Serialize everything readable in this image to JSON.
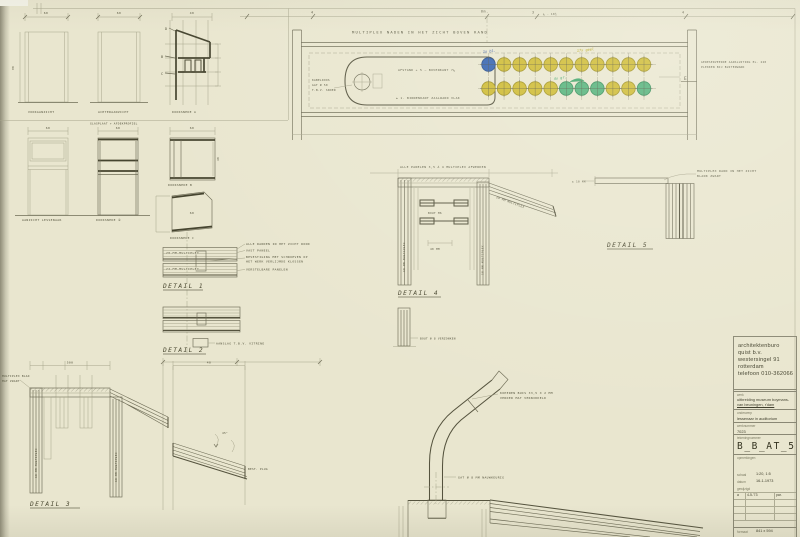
{
  "title_block": {
    "firm_lines": [
      "architektenburo",
      "quist b.v.",
      "westersingel 91",
      "rotterdam",
      "telefoon 010-362066"
    ],
    "werk_label": "werk",
    "werk_value_1": "uitbreiding museum boymans-",
    "werk_value_2": "van beuningen, r'dam",
    "onderwerp_label": "onderwerp",
    "onderwerp_value": "lessenaar in auditorium",
    "werknummer_label": "werknummer",
    "werknummer_value": "7023",
    "tekeningnummer_label": "tekeningnummer",
    "tekeningnummer_value": "B_B_AT_5",
    "opmerkingen_label": "opmerkingen",
    "schaal_label": "schaal",
    "schaal_value": "1:20, 1:5",
    "datum_label": "datum",
    "datum_value": "16-1-1973",
    "gewijzigd_label": "gewijzigd",
    "gewijzigd_row": {
      "letter": "a",
      "date": "4-5-'73",
      "par": "par."
    },
    "formaat_label": "formaat",
    "formaat_value": "841 x 594"
  },
  "plan": {
    "top_note": "MULTIPLEX NADEN IN HET ZICHT BOVEN RAND",
    "dim_4_left": "4",
    "dim_6m": "6m.",
    "dim_3": "3",
    "dim_fraction": "¼ - 10½",
    "dim_4_right": "4",
    "lectern_note_1": "AFSTAND + 5 — BOVENKANT 7¼",
    "lectern_note_2": "± 1. BINNENKANT ZAALWAND VLAK",
    "left_note_lines": [
      "KABELDOOS",
      "GAT Ø 50",
      "T.B.V. SNOER"
    ],
    "right_note_1": "GERESERVEERDE AANSLUITING EL. 220",
    "right_note_2": "PLEKKEN BIJ BUITENWAND",
    "marker_e": "E",
    "count_blue": "1x bl.",
    "count_yellow": "17x geel",
    "count_green": "4x gr.",
    "circle_rows": [
      [
        "blue",
        "yellow",
        "yellow",
        "yellow",
        "yellow",
        "yellow",
        "yellow",
        "yellow",
        "yellow",
        "yellow",
        "yellow"
      ],
      [
        "yellow",
        "yellow",
        "yellow",
        "yellow",
        "yellow",
        "green",
        "green",
        "green",
        "yellow",
        "yellow",
        "green"
      ]
    ],
    "colors": {
      "blue": "#2f5fae",
      "blue_stroke": "#1f4687",
      "yellow": "#cdb92e",
      "yellow_stroke": "#9e8f1b",
      "green": "#4fb077",
      "green_stroke": "#2e8a54"
    }
  },
  "elevations": {
    "dim_60_a": "60",
    "dim_60_b": "60",
    "dim_40": "40",
    "dim_90": "90",
    "label_front": "VOORAANZICHT",
    "label_back": "ACHTERAANZICHT",
    "label_section_a": "DOORSNEDE A",
    "marker_d": "D",
    "marker_b": "B",
    "marker_c": "C",
    "dim_60_c": "60",
    "dim_60_d": "60",
    "dim_60_e": "60",
    "glas_note": "GLASPLAAT + AFDEKPROFIEL",
    "label_cab1": "AANZICHT LESSENAAR",
    "label_cab2": "DOORSNEDE ②",
    "label_square": "DOORSNEDE B",
    "label_pent": "DOORSNEDE C",
    "pent_dim": "60",
    "square_dim_40": "40"
  },
  "details": {
    "post_text": "18 MM MULTIPLEX",
    "d1": {
      "label": "DETAIL  1",
      "bar1": "28 MM MULTIPLEX",
      "bar2": "22 MM MULTIPLEX",
      "note_a": "ALLE RANDEN IN HET ZICHT ROND",
      "note_b": "VAST PANEEL",
      "note_c1": "BEVESTIGING MET SCHROEVEN OP",
      "note_c2": "HET WERK VERLIJMDE KLOSSEN",
      "note_d": "VERSTELBARE PANELEN"
    },
    "d2": {
      "label": "DETAIL  2",
      "note": "AANSLAG T.B.V. VITRINE"
    },
    "d3": {
      "label": "DETAIL  3",
      "note1": "MULTIPLEX BLAD",
      "note2": "MAT ZWART",
      "dim_500": "500",
      "dim_40": "40",
      "slope_note": "BEST. PLUG",
      "angle": "45°"
    },
    "d4": {
      "label": "DETAIL  4",
      "top_note": "ALLE PANELEN 3,5 À 4 MULTIPLEX AFWERKEN",
      "bolt_note": "BOUT M6",
      "dim_40": "40 MM",
      "diag_text": "28 MM MULTIPLEX",
      "lower_note": "BOUT Ø 8 VERZONKEN"
    },
    "d5": {
      "label": "DETAIL  5",
      "note1": "MULTIPLEX RAND IN HET ZICHT",
      "note2": "BLANK ZWART",
      "left_note": "± 10 MM"
    },
    "tube": {
      "note1": "KOPEREN BUIS 33,5 X 2 MM",
      "note2": "VERDER MAT VERNIKKELD",
      "note3": "GAT Ø 8 MM NAUWKEURIG"
    }
  }
}
